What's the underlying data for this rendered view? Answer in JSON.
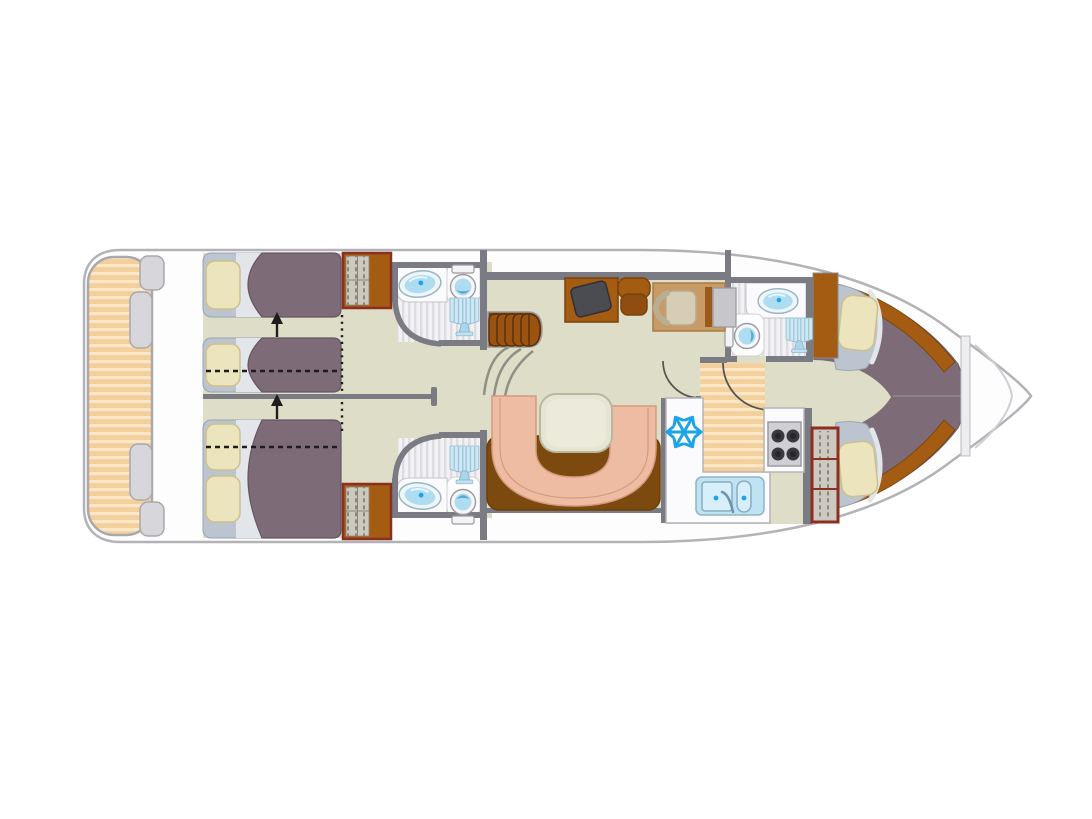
{
  "diagram": {
    "type": "houseboat-floor-plan",
    "orientation": "bow-right-stern-left"
  },
  "icons": {
    "freezer": "snowflake-icon",
    "shower": "shower-head-icon",
    "sink": "washbasin-icon",
    "toilet": "toilet-icon",
    "stove": "four-burner-hob-icon",
    "bed_slide": "up-arrow-icon"
  },
  "colors": {
    "hullFill": "#fdfdfe",
    "hullLine": "#b3b3b7",
    "floor": "#deddc7",
    "wall": "#7b7b83",
    "steel": "#9a9aa0",
    "wood": "#a35c12",
    "woodDark": "#7a4208",
    "stepWood": "#9a5410",
    "stepDark": "#5e300a",
    "stepBg": "#7a400c",
    "sofaBase": "#7c4a0e",
    "bedspread": "#7d6b77",
    "bedspreadEdge": "#665663",
    "pillow": "#ece4bc",
    "pillowEdge": "#cdc189",
    "bedBase": "#bcc4d0",
    "bedBaseEdge": "#9aa4b2",
    "sheet": "#e2e5ea",
    "deckStripeA": "#f3cf9c",
    "deckStripeB": "#f9e7c8",
    "bathStripeA": "#f2f2f5",
    "bathStripeB": "#dcdce1",
    "fixtureLight": "#d8eef8",
    "fixtureBlue": "#aedcf0",
    "fixtureDeep": "#5aa8d0",
    "accentBlue": "#1ca3e8",
    "fixtureEdge": "#9ab4c0",
    "salmon": "#eebca2",
    "salmonEdge": "#d59a7e",
    "tableFill": "#e6e5d3",
    "tableEdge": "#b9b89e",
    "tv": "#4b4b52",
    "counter": "#fbfbfd",
    "counterEdge": "#b5b5ba",
    "stoveTop": "#cfcfd4",
    "burner": "#38383e",
    "louver": "#ccc9c0",
    "louverSlat": "#8d8778",
    "frameRed": "#8c2f20",
    "tan": "#c89a66",
    "tanEdge": "#a87c46",
    "panelGray": "#c6c6cb",
    "seat": "#d6cdb4",
    "seatEdge": "#b5ab90",
    "tabGray": "#d7d7db",
    "tabEdge": "#a9a9ad",
    "arrowBlack": "#1d1d1d",
    "arcLine": "#8f8f86",
    "partition": "#ededf0",
    "doorArc": "#55554d"
  }
}
